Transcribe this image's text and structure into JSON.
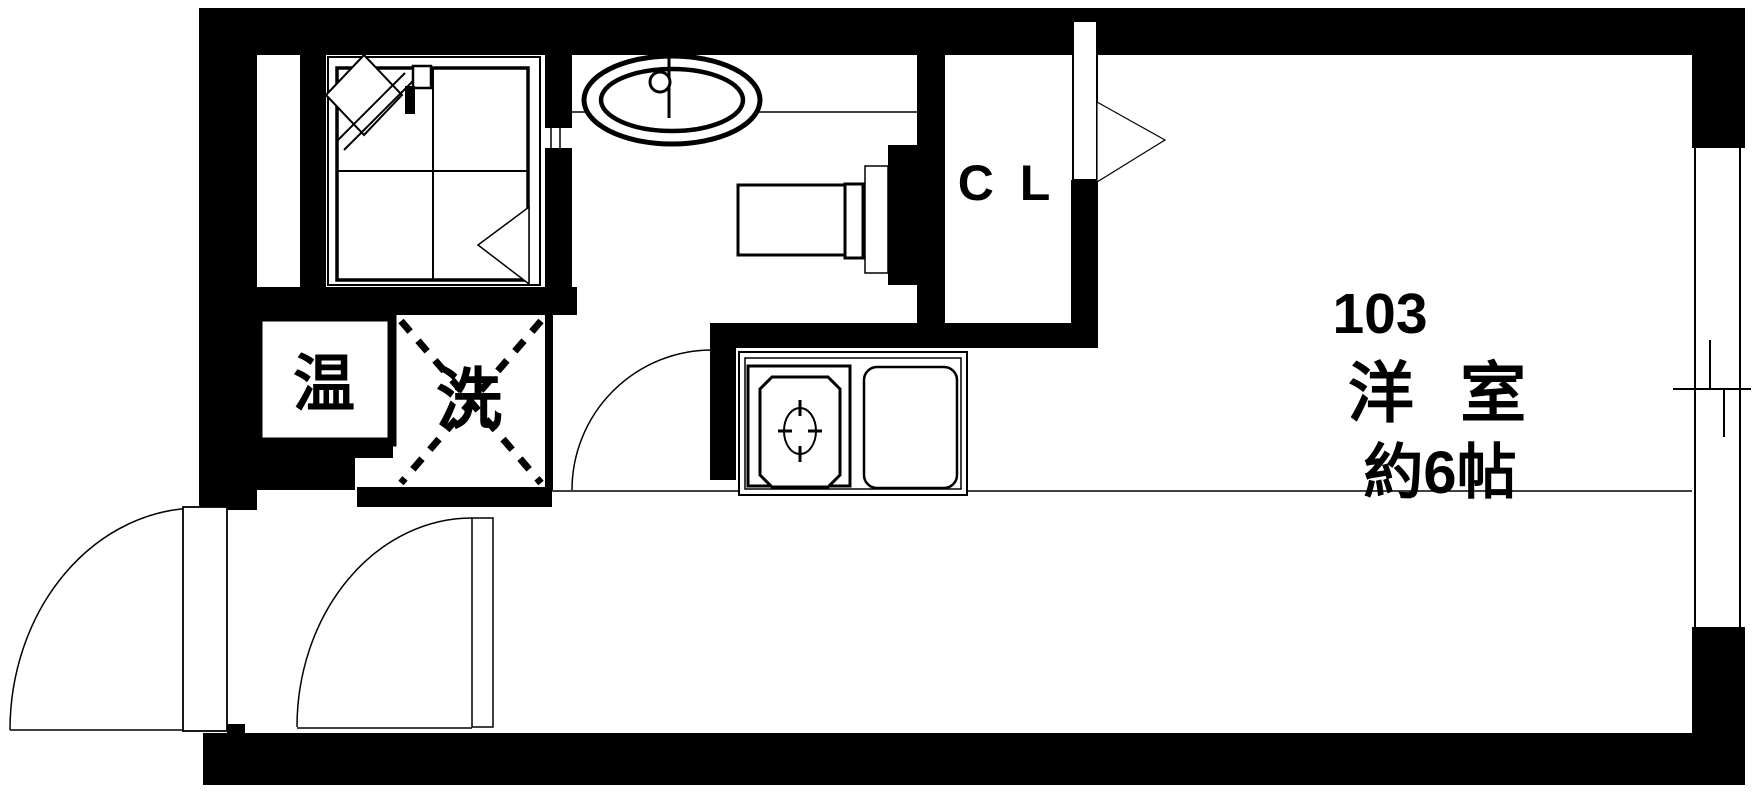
{
  "plan": {
    "unit_number": "103",
    "room_label": "洋 室",
    "room_size": "約6帖",
    "closet_label": "C L",
    "water_heater_label": "温",
    "washer_label": "洗"
  },
  "colors": {
    "wall": "#000000",
    "line": "#000000",
    "background": "#ffffff"
  },
  "fixtures": [
    "unit-bath",
    "bathtub",
    "bath-door",
    "washbasin",
    "toilet",
    "kitchen-counter",
    "kitchen-sink",
    "washing-machine-space",
    "water-heater",
    "closet",
    "closet-door",
    "entrance-door",
    "hall-door",
    "washroom-door",
    "sliding-window"
  ]
}
